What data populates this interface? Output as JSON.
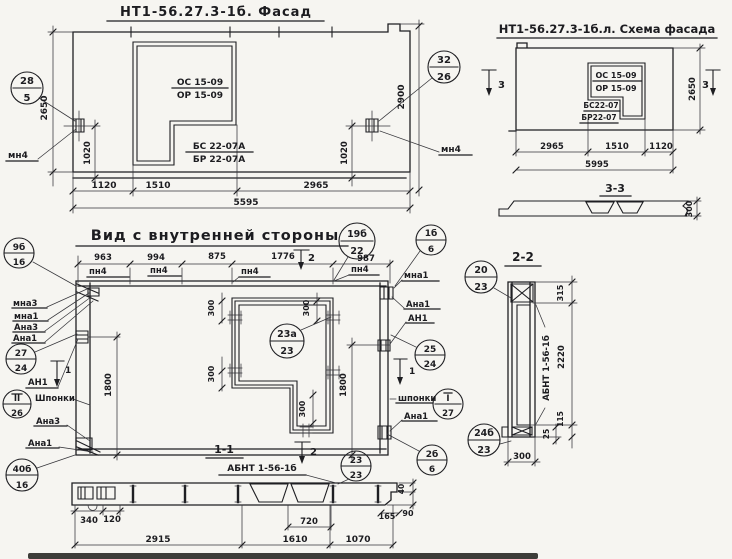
{
  "colors": {
    "ink": "#1e1e22",
    "paper": "#f6f5f1"
  },
  "facade": {
    "title": "НТ1-56.27.3-1б. Фасад",
    "window_mark_top": "ОС 15-09",
    "window_mark_bottom": "ОР 15-09",
    "block_mark_top": "БС 22-07А",
    "block_mark_bottom": "БР 22-07А",
    "callout_left": {
      "top": "28",
      "bottom": "5"
    },
    "callout_right": {
      "top": "32",
      "bottom": "26"
    },
    "anchor_left": "мн4",
    "anchor_right": "мн4",
    "dim_height_left": "2650",
    "dim_anchor_left": "1020",
    "dim_height_right": "2900",
    "dim_anchor_right": "1020",
    "dims_bottom": [
      "1120",
      "1510",
      "2965"
    ],
    "dim_total": "5595"
  },
  "schema": {
    "title": "НТ1-56.27.3-1б.л. Схема фасада",
    "window_mark_top": "ОС 15-09",
    "window_mark_bottom": "ОР 15-09",
    "block_mark_top": "БС22-07",
    "block_mark_bottom": "БР22-07",
    "section_left": "3",
    "section_right": "3",
    "dim_height": "2650",
    "dims_bottom": [
      "2965",
      "1510",
      "1120"
    ],
    "dim_total": "5995",
    "section33": {
      "title": "3-3",
      "dim": "300"
    }
  },
  "interior": {
    "title": "Вид с внутренней стороны",
    "dims_top": [
      "963",
      "994",
      "875",
      "1776",
      "987"
    ],
    "pn": [
      "пн4",
      "пн4",
      "пн4",
      "пн4"
    ],
    "marks": {
      "top": "2",
      "left": "1",
      "right": "1"
    },
    "labels_left": [
      "мна3",
      "мна1",
      "Ана3",
      "Ана1",
      "АН1",
      "Шпонки",
      "Ана3",
      "Ана1"
    ],
    "labels_right": [
      "мна1",
      "Ана1",
      "АН1",
      "шпонки",
      "Ана1"
    ],
    "win300": [
      "300",
      "300",
      "300",
      "300"
    ],
    "dim_left": "1800",
    "dim_right": "1800",
    "callouts": {
      "c19": {
        "top": "19б",
        "bottom": "22"
      },
      "c1b": {
        "top": "1б",
        "bottom": "6"
      },
      "c9b": {
        "top": "9б",
        "bottom": "16"
      },
      "c27": {
        "top": "27",
        "bottom": "24"
      },
      "cII": {
        "top": "II",
        "bottom": "26"
      },
      "c40": {
        "top": "40б",
        "bottom": "16"
      },
      "c23a": {
        "top": "23а",
        "bottom": "23"
      },
      "c25": {
        "top": "25",
        "bottom": "24"
      },
      "cI": {
        "top": "I",
        "bottom": "27"
      },
      "c2b": {
        "top": "2б",
        "bottom": "6"
      }
    }
  },
  "section11": {
    "title": "1-1",
    "mark": "2",
    "label": "АБНТ 1-56-1б",
    "callout": {
      "top": "23",
      "bottom": "23"
    },
    "dims": {
      "d340": "340",
      "d120": "120",
      "d2915": "2915",
      "d720": "720",
      "d1610": "1610",
      "d1070": "1070",
      "d165": "165",
      "d90": "90",
      "d40": "40"
    }
  },
  "section22": {
    "title": "2-2",
    "label": "АБНТ 1-56-1б",
    "callout_top": {
      "top": "20",
      "bottom": "23"
    },
    "callout_bottom": {
      "top": "24б",
      "bottom": "23"
    },
    "dims": {
      "d315": "315",
      "d2220": "2220",
      "d115": "115",
      "d25": "25",
      "d300": "300"
    }
  }
}
